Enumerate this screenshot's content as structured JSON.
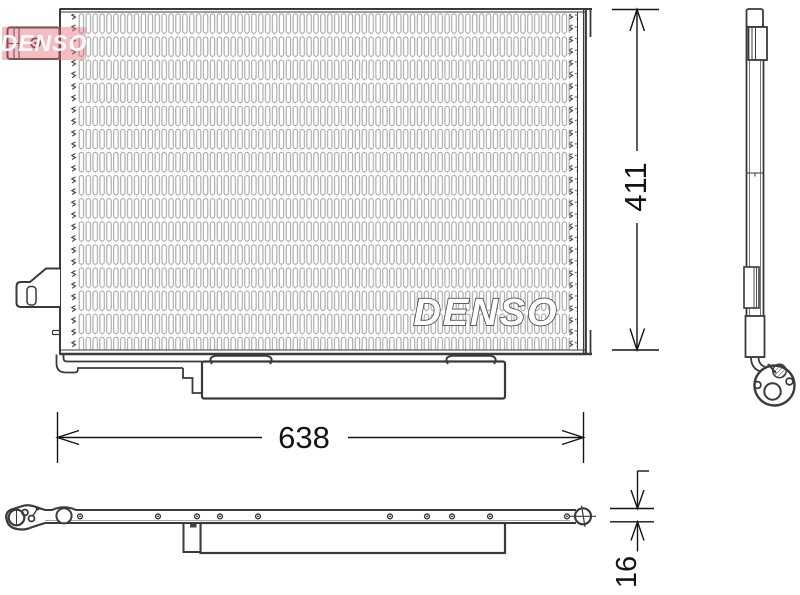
{
  "drawing": {
    "description_labels": {},
    "brand_logo": {
      "text": "DENSO"
    },
    "watermark": {
      "text": "DENSO",
      "color": "#e26c7a"
    },
    "dimensions": {
      "width": {
        "value": "638"
      },
      "height": {
        "value": "411"
      },
      "depth": {
        "value": "16"
      }
    },
    "colors": {
      "outline": "#3a3a3a",
      "fins": "#9e9e9e",
      "dimension": "#141414"
    }
  }
}
